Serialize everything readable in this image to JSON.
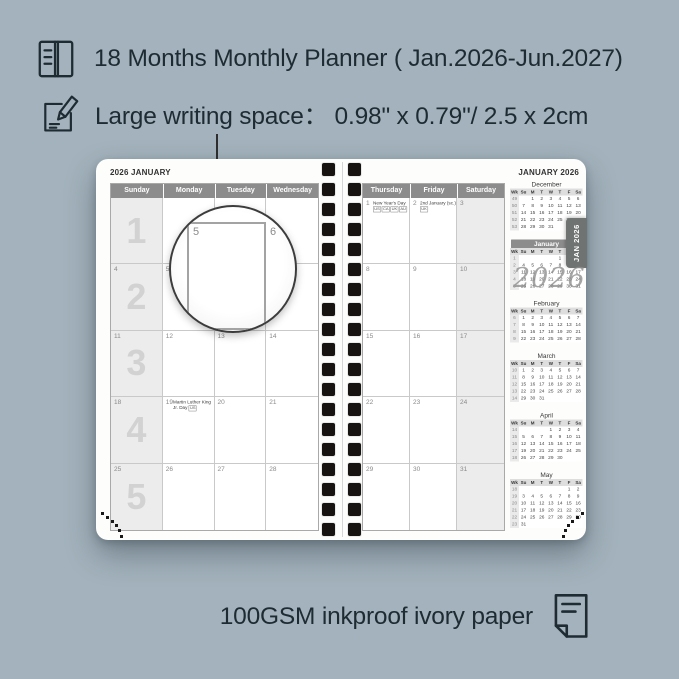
{
  "annotations": {
    "line1": "18 Months Monthly Planner ( Jan.2026-Jun.2027)",
    "line2": "Large writing space：  0.98\" x 0.79\"/ 2.5 x 2cm",
    "bottom": "100GSM inkproof ivory paper"
  },
  "icons": {
    "top": "book-icon",
    "middle": "pencil-note-icon",
    "bottom": "paper-sheet-icon"
  },
  "colors": {
    "background": "#a3b2bc",
    "ink": "#1e2b33",
    "header_gray": "#8c8c8c",
    "shade": "#ececec",
    "tab": "#6f7372",
    "page": "#fdfdfc"
  },
  "planner": {
    "left_page": {
      "title": "2026 JANUARY",
      "day_headers": [
        "Sunday",
        "Monday",
        "Tuesday",
        "Wednesday"
      ],
      "week_numbers": [
        "1",
        "2",
        "3",
        "4",
        "5"
      ],
      "date_rows": [
        [
          "",
          "",
          "",
          ""
        ],
        [
          "4",
          "5",
          "6",
          "7"
        ],
        [
          "11",
          "12",
          "13",
          "14"
        ],
        [
          "18",
          "19",
          "20",
          "21"
        ],
        [
          "25",
          "26",
          "27",
          "28"
        ]
      ],
      "holidays": [
        {
          "row": 3,
          "col": 1,
          "text": "Martin Luther King Jr. Day",
          "badges": [
            "US"
          ]
        }
      ]
    },
    "right_page": {
      "title": "JANUARY 2026",
      "day_headers": [
        "Thursday",
        "Friday",
        "Saturday"
      ],
      "date_rows": [
        [
          "1",
          "2",
          "3"
        ],
        [
          "8",
          "9",
          "10"
        ],
        [
          "15",
          "16",
          "17"
        ],
        [
          "22",
          "23",
          "24"
        ],
        [
          "29",
          "30",
          "31"
        ]
      ],
      "holidays": [
        {
          "row": 0,
          "col": 0,
          "text": "New Year's Day",
          "badges": [
            "US",
            "CA",
            "UK",
            "AU"
          ]
        },
        {
          "row": 0,
          "col": 1,
          "text": "2nd January (sc.)",
          "badges": [
            "UK"
          ]
        }
      ]
    },
    "tab_label": "JAN 2026",
    "watermark": "2026",
    "magnifier": {
      "left_date": "5",
      "right_date": "6"
    },
    "mini_header": [
      "Wk",
      "Su",
      "M",
      "T",
      "W",
      "T",
      "F",
      "Sa"
    ],
    "mini_calendars": [
      {
        "name": "December",
        "highlighted": false,
        "rows": [
          [
            "49",
            "",
            "1",
            "2",
            "3",
            "4",
            "5",
            "6"
          ],
          [
            "50",
            "7",
            "8",
            "9",
            "10",
            "11",
            "12",
            "13"
          ],
          [
            "51",
            "14",
            "15",
            "16",
            "17",
            "18",
            "19",
            "20"
          ],
          [
            "52",
            "21",
            "22",
            "23",
            "24",
            "25",
            "26",
            "27"
          ],
          [
            "53",
            "28",
            "29",
            "30",
            "31",
            "",
            "",
            ""
          ]
        ]
      },
      {
        "name": "January",
        "highlighted": true,
        "rows": [
          [
            "1",
            "",
            "",
            "",
            "",
            "1",
            "2",
            "3"
          ],
          [
            "2",
            "4",
            "5",
            "6",
            "7",
            "8",
            "9",
            "10"
          ],
          [
            "3",
            "11",
            "12",
            "13",
            "14",
            "15",
            "16",
            "17"
          ],
          [
            "4",
            "18",
            "19",
            "20",
            "21",
            "22",
            "23",
            "24"
          ],
          [
            "5",
            "25",
            "26",
            "27",
            "28",
            "29",
            "30",
            "31"
          ]
        ]
      },
      {
        "name": "February",
        "highlighted": false,
        "rows": [
          [
            "6",
            "1",
            "2",
            "3",
            "4",
            "5",
            "6",
            "7"
          ],
          [
            "7",
            "8",
            "9",
            "10",
            "11",
            "12",
            "13",
            "14"
          ],
          [
            "8",
            "15",
            "16",
            "17",
            "18",
            "19",
            "20",
            "21"
          ],
          [
            "9",
            "22",
            "23",
            "24",
            "25",
            "26",
            "27",
            "28"
          ]
        ]
      },
      {
        "name": "March",
        "highlighted": false,
        "rows": [
          [
            "10",
            "1",
            "2",
            "3",
            "4",
            "5",
            "6",
            "7"
          ],
          [
            "11",
            "8",
            "9",
            "10",
            "11",
            "12",
            "13",
            "14"
          ],
          [
            "12",
            "15",
            "16",
            "17",
            "18",
            "19",
            "20",
            "21"
          ],
          [
            "13",
            "22",
            "23",
            "24",
            "25",
            "26",
            "27",
            "28"
          ],
          [
            "14",
            "29",
            "30",
            "31",
            "",
            "",
            "",
            ""
          ]
        ]
      },
      {
        "name": "April",
        "highlighted": false,
        "rows": [
          [
            "14",
            "",
            "",
            "",
            "1",
            "2",
            "3",
            "4"
          ],
          [
            "15",
            "5",
            "6",
            "7",
            "8",
            "9",
            "10",
            "11"
          ],
          [
            "16",
            "12",
            "13",
            "14",
            "15",
            "16",
            "17",
            "18"
          ],
          [
            "17",
            "19",
            "20",
            "21",
            "22",
            "23",
            "24",
            "25"
          ],
          [
            "18",
            "26",
            "27",
            "28",
            "29",
            "30",
            "",
            ""
          ]
        ]
      },
      {
        "name": "May",
        "highlighted": false,
        "rows": [
          [
            "18",
            "",
            "",
            "",
            "",
            "",
            "1",
            "2"
          ],
          [
            "19",
            "3",
            "4",
            "5",
            "6",
            "7",
            "8",
            "9"
          ],
          [
            "20",
            "10",
            "11",
            "12",
            "13",
            "14",
            "15",
            "16"
          ],
          [
            "21",
            "17",
            "18",
            "19",
            "20",
            "21",
            "22",
            "23"
          ],
          [
            "22",
            "24",
            "25",
            "26",
            "27",
            "28",
            "29",
            "30"
          ],
          [
            "23",
            "31",
            "",
            "",
            "",
            "",
            "",
            ""
          ]
        ]
      }
    ]
  }
}
